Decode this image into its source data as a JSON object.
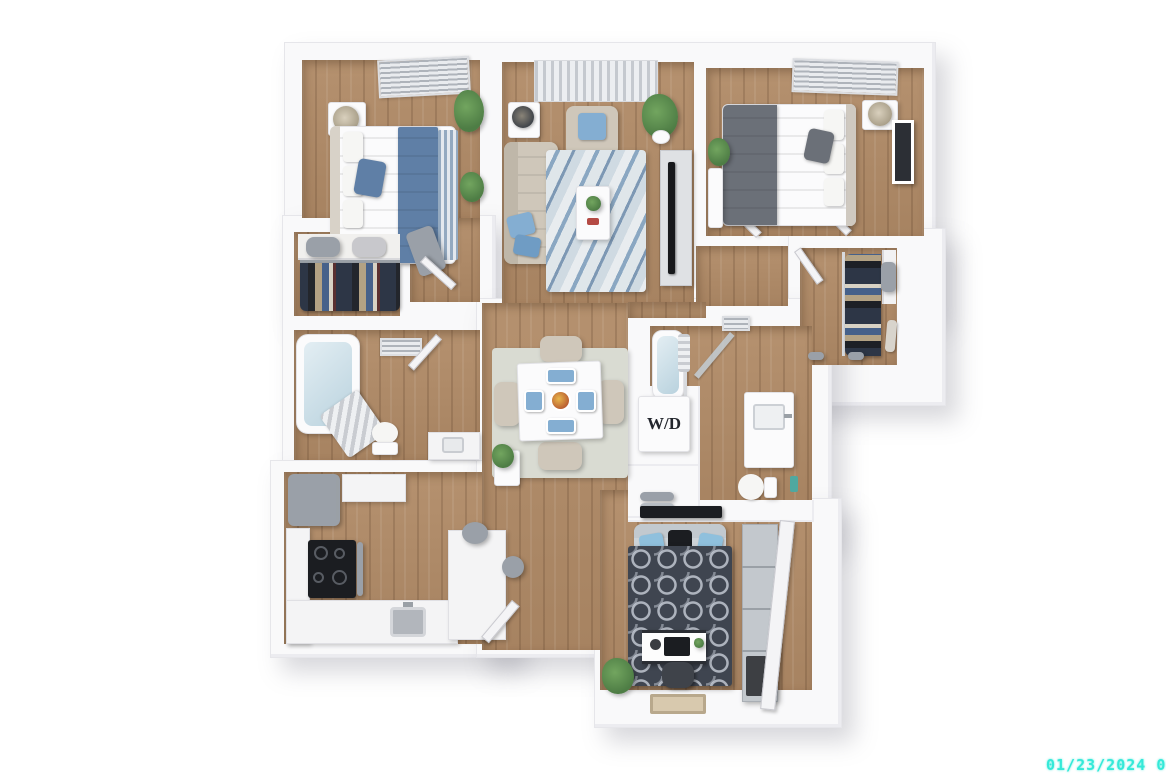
{
  "labels": {
    "washer_dryer": "W/D"
  },
  "overlay": {
    "timestamp": "01/23/2024 06:5"
  },
  "palette": {
    "wall": "#f9f9fa",
    "wall_edge": "#e6e6ea",
    "wood": "#b18b67",
    "rug_marble_blue": "#8aa7c2",
    "rug_dining": "#d9dbd2",
    "rug_den": "#3f4550",
    "accent_blue": "#84aed2",
    "blanket_blue": "#5f7fa6",
    "blanket_gray": "#6b7078",
    "sofa_beige": "#cfc7ba",
    "appliance_gray": "#9aa0a8",
    "cooktop_black": "#1b1d21",
    "plant_green": "#4e7d45",
    "water_blue": "#b9d2de",
    "doormat_tan": "#d8c9ae",
    "label_dark": "#23262d",
    "timestamp_cyan": "#35e9d8"
  }
}
